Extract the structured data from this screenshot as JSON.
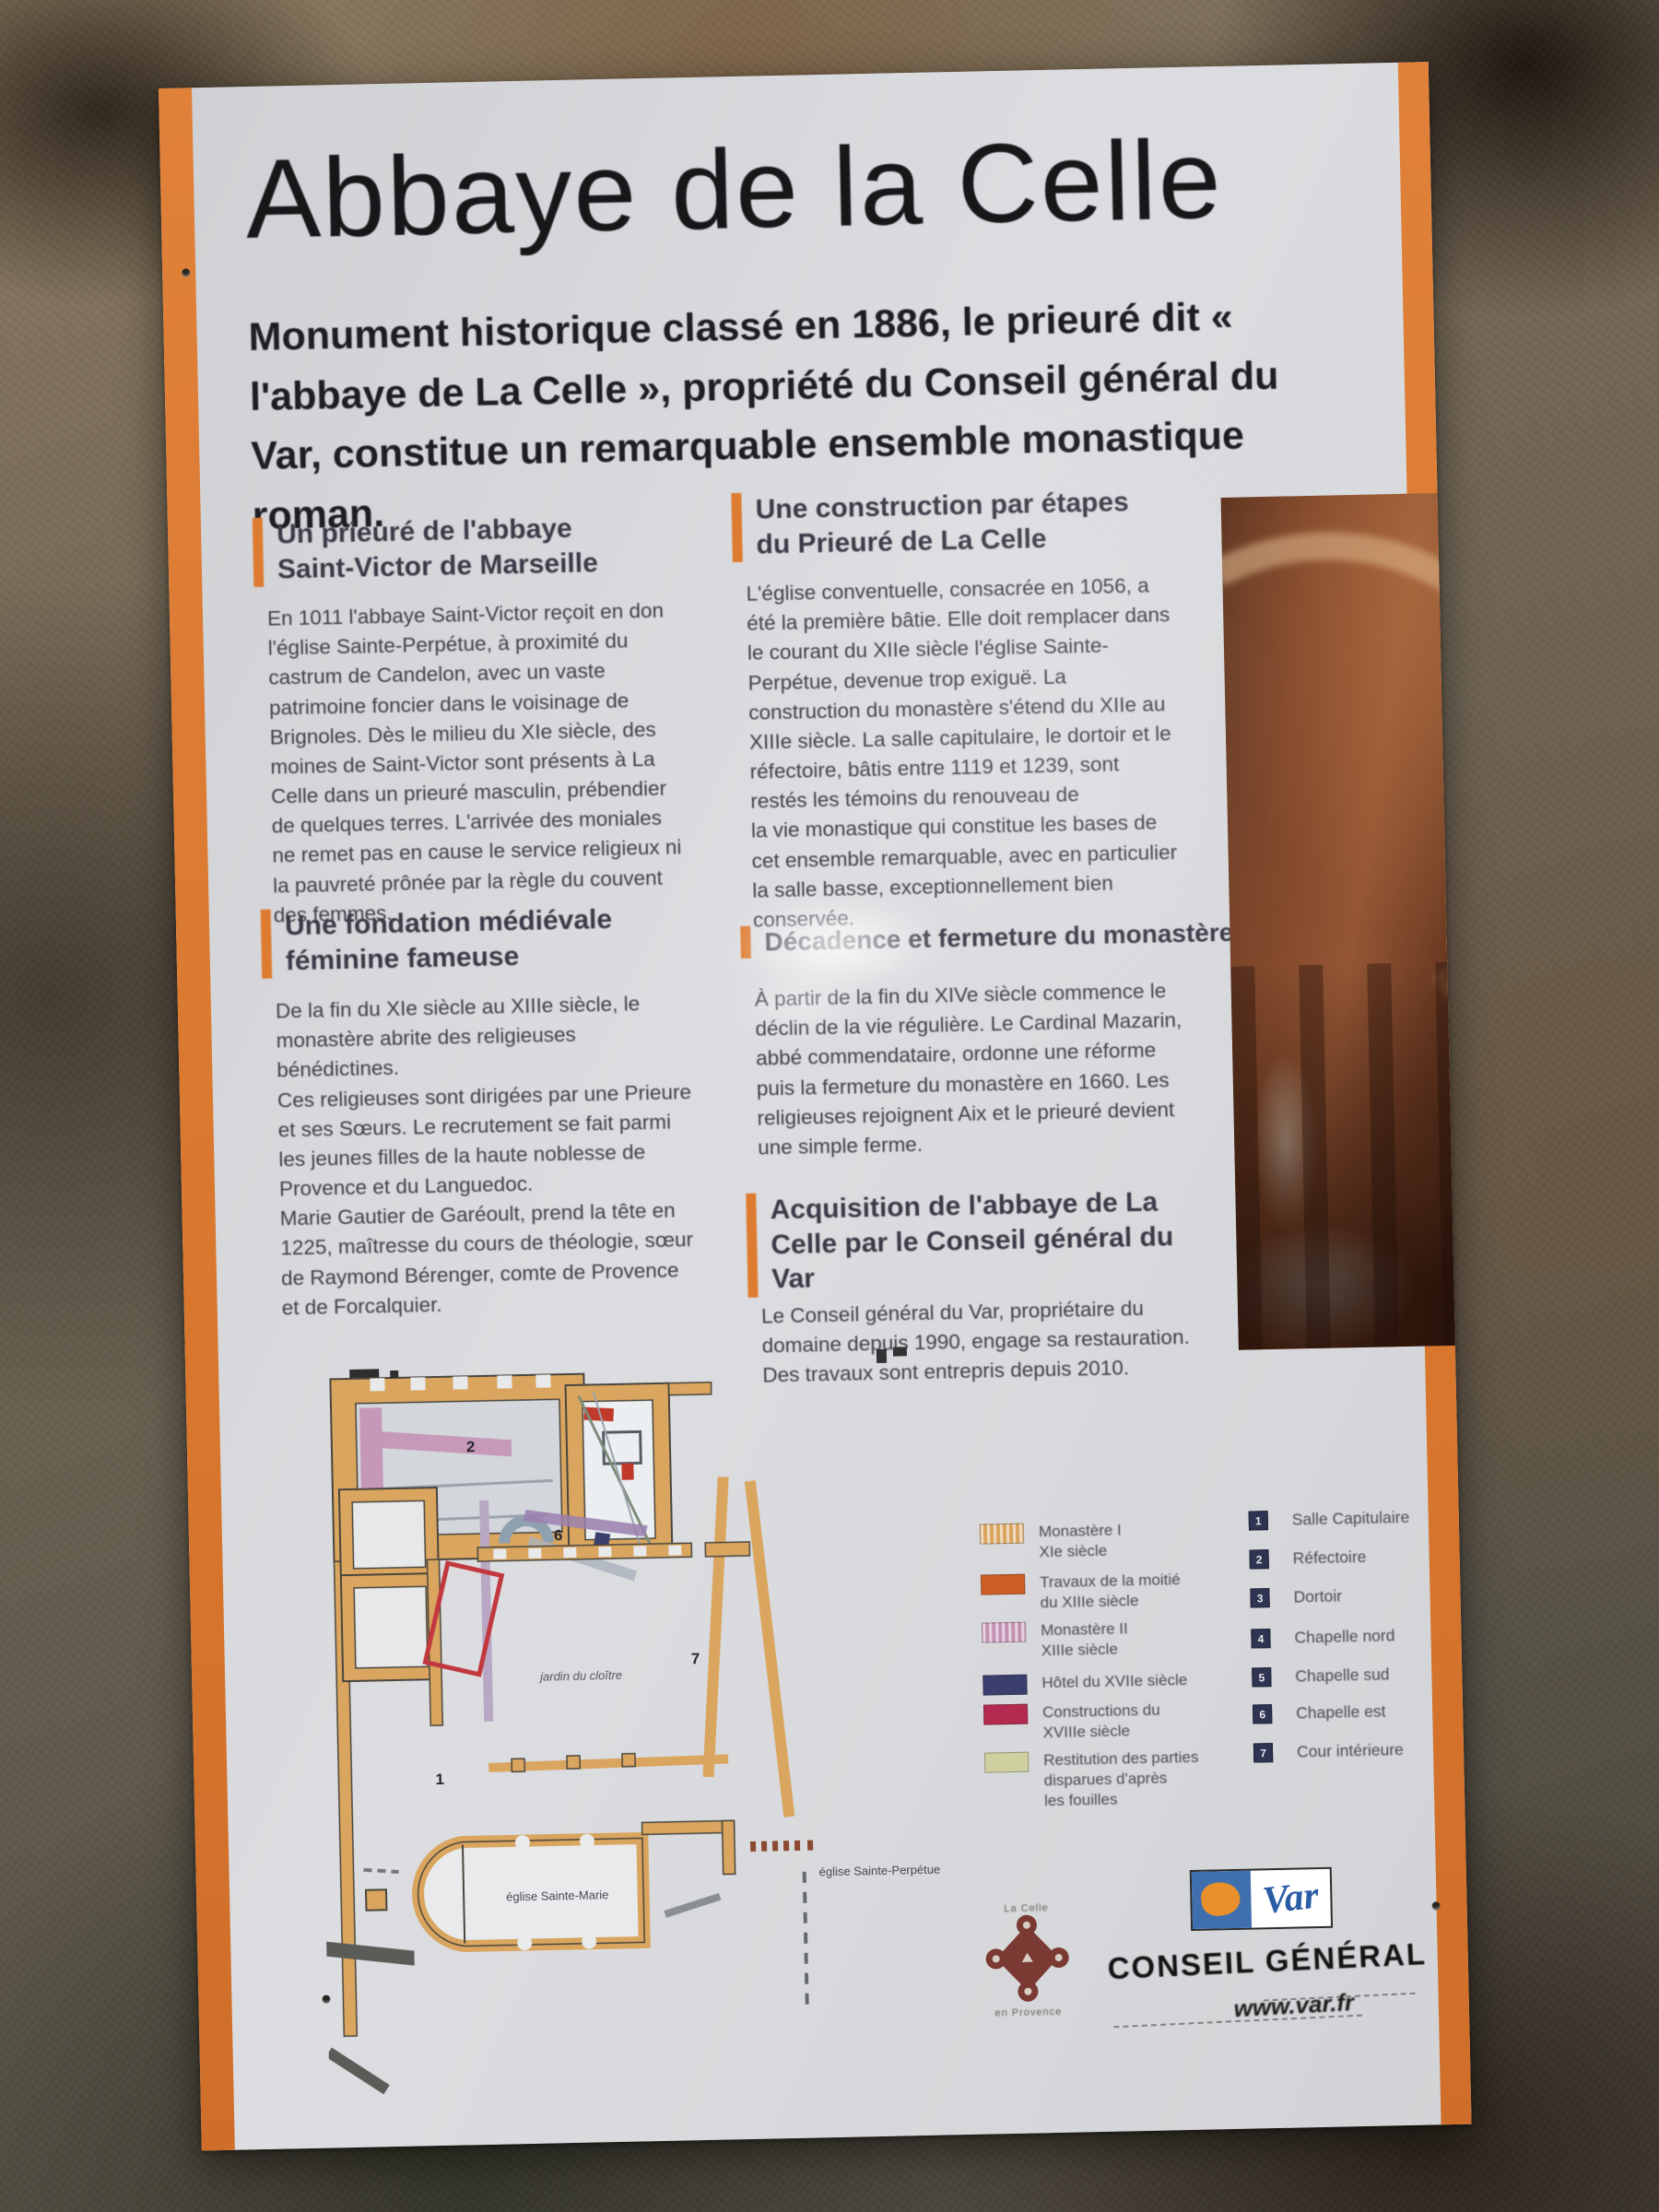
{
  "panel": {
    "title": "Abbaye de la Celle",
    "intro": "Monument historique classé en 1886, le prieuré dit « l'abbaye de La Celle », propriété du Conseil général du Var, constitue un remarquable ensemble monastique roman.",
    "left_sections": [
      {
        "heading": "Un prieuré de l'abbaye Saint-Victor de Marseille",
        "body": "En 1011 l'abbaye Saint-Victor reçoit en don l'église Sainte-Perpétue, à proximité du castrum de Candelon, avec un vaste patrimoine foncier dans le voisinage de Brignoles. Dès le milieu du XIe siècle, des moines de Saint-Victor sont présents à La Celle dans un prieuré masculin, prébendier de quelques terres. L'arrivée des moniales ne remet pas en cause le service religieux ni la pauvreté prônée par la règle du couvent des femmes."
      },
      {
        "heading": "Une fondation médiévale féminine fameuse",
        "body": "De la fin du XIe siècle au XIIIe siècle, le monastère abrite des religieuses bénédictines.\nCes religieuses sont dirigées par une Prieure et ses Sœurs. Le recrutement se fait parmi les jeunes filles de la haute noblesse de Provence et du Languedoc.\nMarie Gautier de Garéoult, prend la tête en 1225, maîtresse du cours de théologie, sœur de Raymond Bérenger, comte de Provence et de Forcalquier."
      }
    ],
    "right_sections": [
      {
        "heading": "Une construction par étapes du Prieuré de La Celle",
        "body": "L'église conventuelle, consacrée en 1056, a été la première bâtie. Elle doit remplacer dans le courant du XIIe siècle l'église Sainte-Perpétue, devenue trop exiguë. La construction du monastère s'étend du XIIe au XIIIe siècle. La salle capitulaire, le dortoir et le réfectoire, bâtis entre 1119 et 1239, sont restés les témoins du renouveau de\nla vie monastique qui constitue les bases de cet ensemble remarquable, avec en particulier la salle basse, exceptionnellement bien conservée."
      },
      {
        "heading": "Décadence et fermeture du monastère",
        "body": "À partir de la fin du XIVe siècle commence le déclin de la vie régulière. Le Cardinal Mazarin, abbé commendataire, ordonne une réforme puis la fermeture du monastère en 1660. Les religieuses rejoignent Aix et le prieuré devient une simple ferme."
      },
      {
        "heading": "Acquisition de l'abbaye de La Celle par le Conseil général du Var",
        "body": "Le Conseil général du Var, propriétaire du domaine depuis 1990, engage sa restauration. Des travaux sont entrepris depuis 2010."
      }
    ]
  },
  "plan": {
    "labels": {
      "church": "église Sainte-Marie",
      "ruin": "église Sainte-Perpétue",
      "cloister": "jardin du cloître"
    },
    "markers": [
      "2",
      "6",
      "7",
      "1"
    ]
  },
  "legend": {
    "materials": [
      {
        "color": "#d9a55f",
        "swatch_style": "background-color:#d9a55f",
        "label": "Monastère I\nXIe siècle"
      },
      {
        "color": "#cf5e26",
        "swatch_style": "background-color:#cf5e26",
        "label": "Travaux de la moitié\ndu XIIIe siècle"
      },
      {
        "color": "#c392b3",
        "swatch_style": "background-color:#c392b3",
        "label": "Monastère II\nXIIIe siècle"
      },
      {
        "color": "#3b3f6e",
        "swatch_style": "background-color:#3b3f6e",
        "label": "Hôtel du XVIIe siècle"
      },
      {
        "color": "#b52a50",
        "swatch_style": "background-color:#b52a50",
        "label": "Constructions du\nXVIIIe siècle"
      },
      {
        "color": "#cfd0a0",
        "swatch_style": "background-color:#cfd0a0",
        "label": "Restitution des parties\ndisparues d'après\nles fouilles"
      }
    ],
    "rooms": [
      {
        "num": "1",
        "label": "Salle Capitulaire"
      },
      {
        "num": "2",
        "label": "Réfectoire"
      },
      {
        "num": "3",
        "label": "Dortoir"
      },
      {
        "num": "4",
        "label": "Chapelle nord"
      },
      {
        "num": "5",
        "label": "Chapelle sud"
      },
      {
        "num": "6",
        "label": "Chapelle est"
      },
      {
        "num": "7",
        "label": "Cour intérieure"
      }
    ]
  },
  "footer": {
    "commune_logo_top": "La Celle",
    "commune_logo_bottom": "en Provence",
    "var_logo_text": "Var",
    "org_name": "CONSEIL GÉNÉRAL",
    "website": "www.var.fr"
  },
  "colors": {
    "accent_orange": "#dd7c31",
    "panel_background": "#d8d9db",
    "legend_navy": "#2f3452"
  }
}
